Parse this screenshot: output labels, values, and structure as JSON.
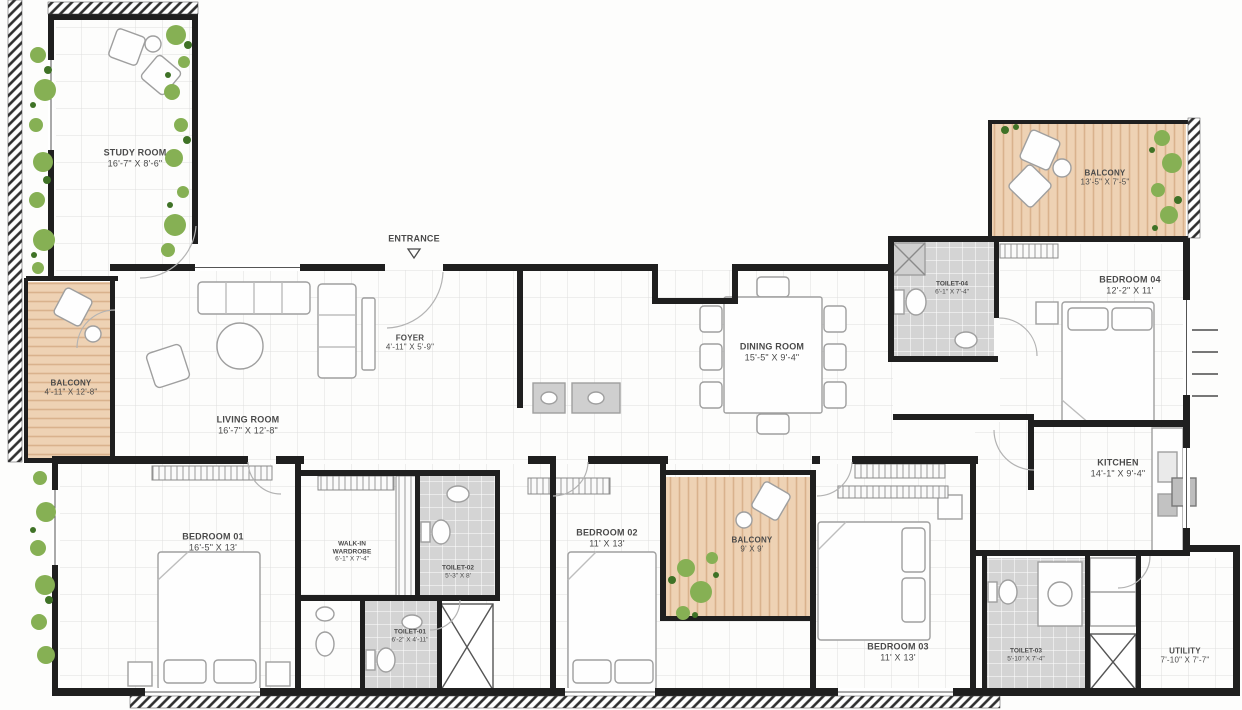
{
  "entrance": {
    "label": "ENTRANCE"
  },
  "colors": {
    "wall": "#1f1f1f",
    "grid_line": "#dedede",
    "balcony_floor": "#eed2b4",
    "balcony_stripe": "#d9b28d",
    "tile_gray": "#d4d4d4",
    "plant_green": "#86b054",
    "plant_green_dark": "#3f7226",
    "label_text": "#4a4a4a"
  },
  "rooms": {
    "study": {
      "name": "STUDY ROOM",
      "dims": "16'-7\" X 8'-6\""
    },
    "balcony_left": {
      "name": "BALCONY",
      "dims": "4'-11\" X 12'-8\""
    },
    "living": {
      "name": "LIVING ROOM",
      "dims": "16'-7\" X 12'-8\""
    },
    "foyer": {
      "name": "FOYER",
      "dims": "4'-11\" X 5'-9\""
    },
    "dining": {
      "name": "DINING ROOM",
      "dims": "15'-5\" X 9'-4\""
    },
    "toilet4": {
      "name": "TOILET-04",
      "dims": "6'-1\" X 7'-4\""
    },
    "bedroom4": {
      "name": "BEDROOM 04",
      "dims": "12'-2\" X 11'"
    },
    "balcony_tr": {
      "name": "BALCONY",
      "dims": "13'-5\" X 7'-5\""
    },
    "kitchen": {
      "name": "KITCHEN",
      "dims": "14'-1\" X 9'-4\""
    },
    "bedroom1": {
      "name": "BEDROOM 01",
      "dims": "16'-5\" X 13'"
    },
    "wardrobe": {
      "name": "WALK-IN WARDROBE",
      "dims": "6'-1\" X 7'-4\""
    },
    "toilet2": {
      "name": "TOILET-02",
      "dims": "5'-3\" X 8'"
    },
    "toilet1": {
      "name": "TOILET-01",
      "dims": "6'-2\" X 4'-11\""
    },
    "bedroom2": {
      "name": "BEDROOM 02",
      "dims": "11' X 13'"
    },
    "balcony_center": {
      "name": "BALCONY",
      "dims": "9' X 9'"
    },
    "bedroom3": {
      "name": "BEDROOM 03",
      "dims": "11' X 13'"
    },
    "toilet3": {
      "name": "TOILET-03",
      "dims": "5'-10\" X 7'-4\""
    },
    "utility": {
      "name": "UTILITY",
      "dims": "7'-10\" X 7'-7\""
    }
  }
}
